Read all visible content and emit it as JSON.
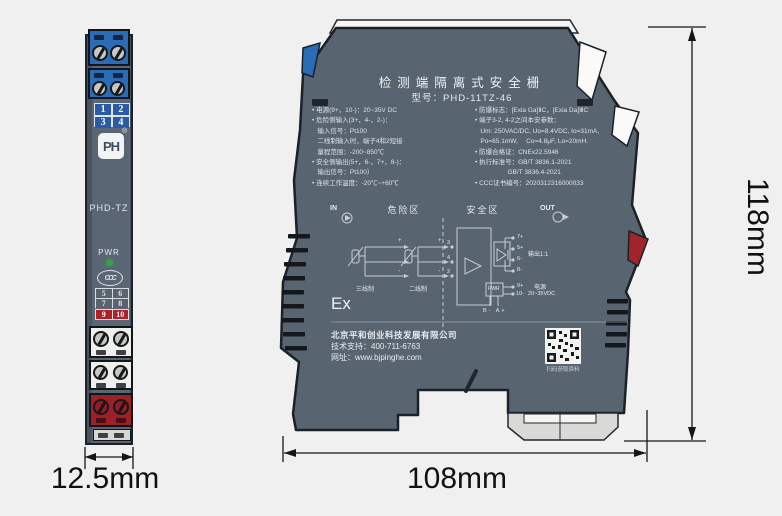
{
  "front_view": {
    "model_label": "PHD-TZ",
    "pwr_label": "PWR",
    "logo_text": "PH",
    "logo_reg": "®",
    "ccc_label": "CCC",
    "grid_top": [
      "1",
      "2",
      "3",
      "4"
    ],
    "grid_mid": [
      "5",
      "6",
      "7",
      "8"
    ],
    "grid_red": [
      "9",
      "10"
    ]
  },
  "side_view": {
    "title": "检测端隔离式安全栅",
    "model_line": "型号：PHD-11TZ-46",
    "specs_left": [
      "• 电源(9+，10-)：20~35V DC",
      "• 危险侧输入(3+，4-，2-)：",
      "   输入信号：Pt100",
      "   二线制输入时，端子4和2短接",
      "   量程范围：-200~850℃",
      "• 安全侧输出(5+，6-，7+，8-)：",
      "   输出信号：Pt100）",
      "• 连续工作温度：-20℃~+60℃"
    ],
    "specs_right": [
      "• 防爆标志：[Exia Ga]ⅡC，[Exia Da]ⅢC",
      "• 端子3-2, 4-2之间本安参数：",
      "   Um: 250VAC/DC, Uo=8.4VDC, Io=31mA,",
      "   Po=65.1mW,　 Co=4.8μF, Lo=20mH.",
      "• 防爆合格证：CNEx22.5946",
      "• 执行标准号：GB/T 3836.1-2021",
      "                  GB/T 3836.4-2021",
      "• CCC证书编号：2020312316000033"
    ],
    "in_label": "IN",
    "out_label": "OUT",
    "zone_danger": "危险区",
    "zone_safe": "安全区",
    "sensor_3wire": "三线制",
    "sensor_2wire": "二线制",
    "plus": "+",
    "minus": "-",
    "input_terminals": [
      "3",
      "4",
      "2"
    ],
    "output_terminals": [
      "7+",
      "5+",
      "6-",
      "8-"
    ],
    "output_ratio": "输出1:1",
    "pwr_box_label": "PWR",
    "power_terminals": [
      "9+",
      "10-"
    ],
    "power_label": "电源",
    "power_range": "20~35VDC",
    "battery_labels": "B- A+",
    "ex_mark": "Ex",
    "company": "北京平和创业科技发展有限公司",
    "support": "技术支持：400-711-6763",
    "website": "网址：www.bjpinghe.com",
    "qr_caption": "扫码获取资料"
  },
  "dimensions": {
    "front_width": "12.5mm",
    "side_width": "108mm",
    "height": "118mm"
  },
  "colors": {
    "body": "#586470",
    "terminal_blue": "#2a6cb5",
    "accent_red": "#9c2127",
    "led_green": "#35a244",
    "dimension_ink": "#161616",
    "background": "#f0f0f0"
  }
}
